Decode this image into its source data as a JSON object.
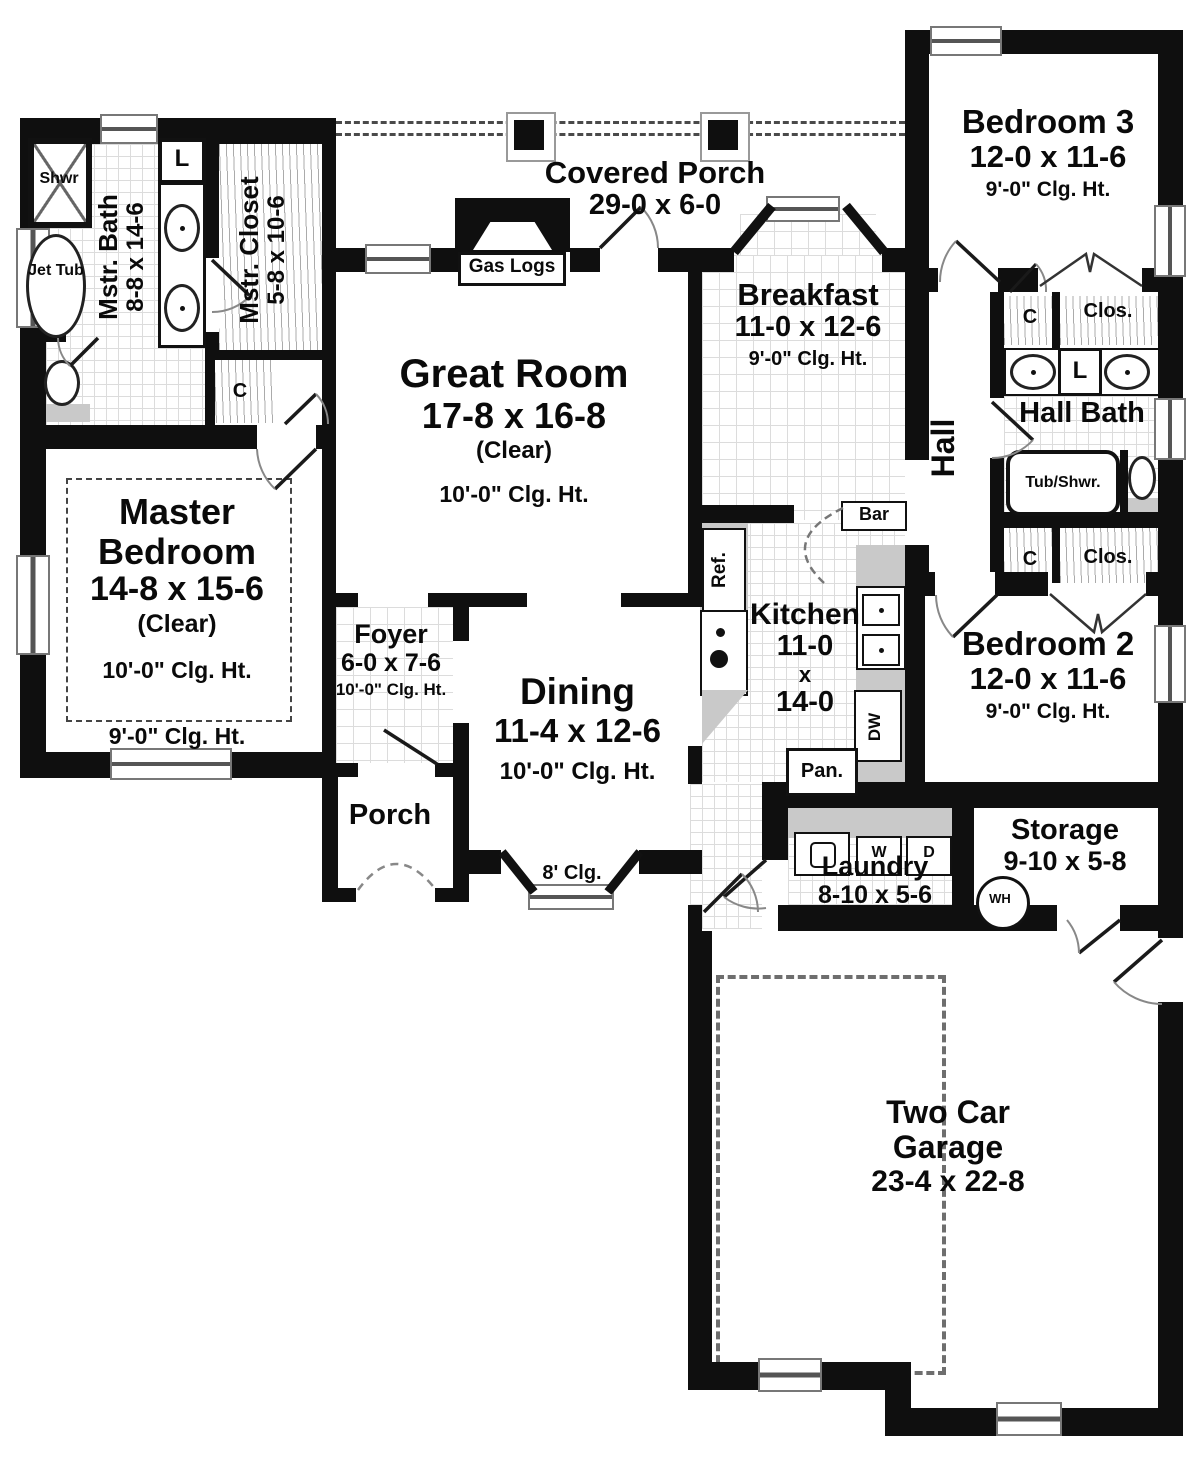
{
  "plan": {
    "covered_porch": {
      "name": "Covered Porch",
      "dims": "29-0 x 6-0"
    },
    "bedroom3": {
      "name": "Bedroom 3",
      "dims": "12-0 x 11-6",
      "ceiling": "9'-0\" Clg. Ht."
    },
    "mstr_bath": {
      "name": "Mstr. Bath",
      "dims": "8-8 x 14-6"
    },
    "shower": "Shwr",
    "jet_tub": "Jet Tub",
    "linen1": "L",
    "linen2": "L",
    "mstr_closet": {
      "name": "Mstr. Closet",
      "dims": "5-8 x 10-6"
    },
    "closet_c1": "C",
    "closet_c2": "C",
    "closet_c3": "C",
    "clos_top": "Clos.",
    "clos_bottom": "Clos.",
    "gas_logs": "Gas Logs",
    "great_room": {
      "name": "Great Room",
      "dims": "17-8 x 16-8",
      "clear": "(Clear)",
      "ceiling": "10'-0\" Clg. Ht."
    },
    "breakfast": {
      "name": "Breakfast",
      "dims": "11-0 x 12-6",
      "ceiling": "9'-0\" Clg. Ht."
    },
    "hall": "Hall",
    "hall_bath": {
      "name": "Hall Bath"
    },
    "tub_shwr": "Tub/Shwr.",
    "master_bedroom": {
      "line1": "Master",
      "line2": "Bedroom",
      "dims": "14-8 x 15-6",
      "clear": "(Clear)",
      "ceiling_in": "10'-0\" Clg. Ht.",
      "ceiling_out": "9'-0\" Clg. Ht."
    },
    "foyer": {
      "name": "Foyer",
      "dims": "6-0 x 7-6",
      "ceiling": "10'-0\" Clg. Ht."
    },
    "dining": {
      "name": "Dining",
      "dims": "11-4 x 12-6",
      "ceiling": "10'-0\" Clg. Ht."
    },
    "porch": "Porch",
    "bay_ceiling": "8' Clg.",
    "bar": "Bar",
    "kitchen": {
      "name": "Kitchen",
      "w": "11-0",
      "x": "x",
      "h": "14-0"
    },
    "ref": "Ref.",
    "dw": "DW",
    "pan": "Pan.",
    "bedroom2": {
      "name": "Bedroom 2",
      "dims": "12-0 x 11-6",
      "ceiling": "9'-0\" Clg. Ht."
    },
    "laundry": {
      "name": "Laundry",
      "dims": "8-10 x 5-6"
    },
    "washer": "W",
    "dryer": "D",
    "storage": {
      "name": "Storage",
      "dims": "9-10 x 5-8"
    },
    "water_heater": "WH",
    "garage": {
      "line1": "Two Car",
      "line2": "Garage",
      "dims": "23-4 x 22-8"
    }
  },
  "colors": {
    "wall": "#0f0f0f",
    "counter": "#c9c9c9",
    "grid_line": "#dcdcdc"
  }
}
